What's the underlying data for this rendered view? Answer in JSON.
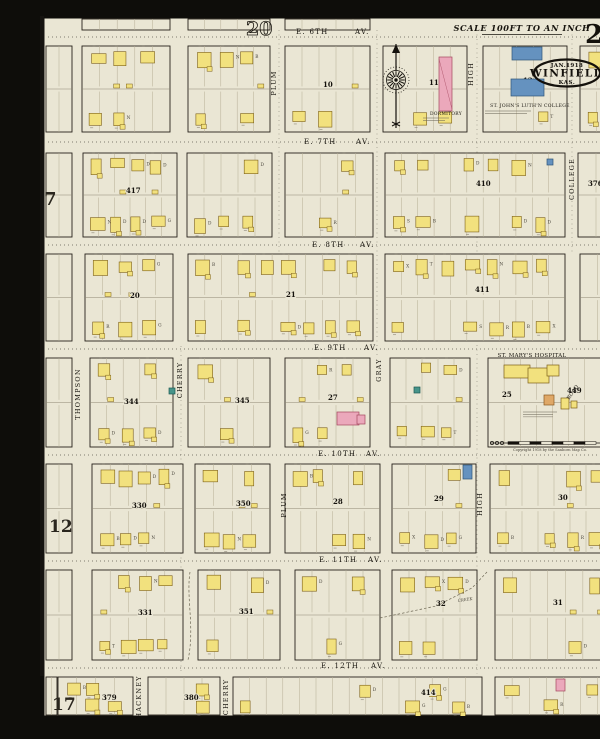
{
  "meta": {
    "sheet_title": "Winfield Kas. Jan. 1918 Sanborn map, sheet 21",
    "scale_text": "SCALE 100FT TO AN INCH",
    "title_oval": {
      "date": "JAN.1918",
      "city": "WINFIELD",
      "state": "KAS."
    },
    "sheet_number": "21",
    "copyright": "Copyright 1918 by the Sanborn Map Co.",
    "colors": {
      "paper": "#eae6d4",
      "ink": "#26211a",
      "lot": "#b5ad94",
      "alley": "#8d8672",
      "frame_fill": "#f2e17e",
      "frame_stroke": "#7c5f17",
      "brick_fill": "#eba8bb",
      "brick_stroke": "#a4485e",
      "special_fill": "#6592bf",
      "special_stroke": "#2e5577",
      "stone_fill": "#47948a",
      "stone_stroke": "#1f5b54",
      "iron_fill": "#dfa867",
      "iron_stroke": "#8a5a20",
      "tiny": "#4a463c"
    }
  },
  "adjacent_sheet_refs": [
    {
      "label": "20",
      "x": 206,
      "y": 19,
      "size": 19,
      "outline": true
    },
    {
      "label": "7",
      "x": 4,
      "y": 189,
      "size": 18,
      "outline": false
    },
    {
      "label": "12",
      "x": 9,
      "y": 516,
      "size": 17,
      "outline": false
    },
    {
      "label": "17",
      "x": 12,
      "y": 694,
      "size": 17,
      "outline": false
    }
  ],
  "sheet_number_pos": {
    "x": 545,
    "y": 27,
    "size": 26
  },
  "corner_numbers": [
    {
      "label": "375",
      "x": 564,
      "y": 73
    }
  ],
  "title_layout": {
    "cx": 527,
    "cy": 57,
    "rx": 33,
    "ry": 13.5,
    "scale_x": 482,
    "scale_y": 15,
    "ul_x1": 442,
    "ul_x2": 522,
    "ul_y": 18.5
  },
  "avenues": [
    {
      "name": "E. 6TH",
      "av": "AV.",
      "xn": 256,
      "xa": 315,
      "y": 18,
      "dash_y": 21
    },
    {
      "name": "E. 7TH",
      "av": "AV.",
      "xn": 264,
      "xa": 316,
      "y": 128,
      "dash_y": 126
    },
    {
      "name": "E. 8TH",
      "av": "AV.",
      "xn": 272,
      "xa": 320,
      "y": 231,
      "dash_y": 229
    },
    {
      "name": "E. 9TH",
      "av": "AV.",
      "xn": 274,
      "xa": 324,
      "y": 334,
      "dash_y": 333
    },
    {
      "name": "E. 10TH",
      "av": "AV.",
      "xn": 278,
      "xa": 326,
      "y": 440,
      "dash_y": 439
    },
    {
      "name": "E. 11TH",
      "av": "AV.",
      "xn": 279,
      "xa": 328,
      "y": 546,
      "dash_y": 545
    },
    {
      "name": "E. 12TH",
      "av": "AV.",
      "xn": 281,
      "xa": 331,
      "y": 652,
      "dash_y": 652
    }
  ],
  "street_labels": [
    {
      "t": "PLUM",
      "x": 236,
      "y": 67
    },
    {
      "t": "PLUM",
      "x": 246,
      "y": 489
    },
    {
      "t": "HIGH",
      "x": 433,
      "y": 58
    },
    {
      "t": "HIGH",
      "x": 442,
      "y": 488
    },
    {
      "t": "GRAY",
      "x": 341,
      "y": 354
    },
    {
      "t": "CHERRY",
      "x": 142,
      "y": 364
    },
    {
      "t": "CHERRY",
      "x": 188,
      "y": 681
    },
    {
      "t": "THOMPSON",
      "x": 40,
      "y": 378
    },
    {
      "t": "COLLEGE",
      "x": 534,
      "y": 163
    },
    {
      "t": "MOUND",
      "x": 584,
      "y": 486
    },
    {
      "t": "HACKNEY",
      "x": 101,
      "y": 681
    }
  ],
  "street_dashes": [
    {
      "x": 239,
      "y1": 14,
      "y2": 236
    },
    {
      "x": 337,
      "y1": 14,
      "y2": 341
    },
    {
      "x": 437,
      "y1": 14,
      "y2": 658
    },
    {
      "x": 532,
      "y1": 14,
      "y2": 238
    },
    {
      "x": 585,
      "y1": 440,
      "y2": 546
    },
    {
      "x": 141,
      "y1": 330,
      "y2": 658
    },
    {
      "x": 580,
      "y1": 344,
      "y2": 430
    }
  ],
  "creek": {
    "path": "M340,602 L396,590 L432,572 L447,556",
    "path2": "M150,556 C146,582 155,612 148,644",
    "label": "CREEK",
    "lx": 418,
    "ly": 586
  },
  "blocks": [
    {
      "r": [
        42,
        3,
        88,
        11
      ],
      "d": 0
    },
    {
      "r": [
        148,
        3,
        82,
        11
      ],
      "d": 0
    },
    {
      "r": [
        245,
        3,
        85,
        11
      ],
      "d": 0
    },
    {
      "r": [
        6,
        30,
        26,
        86
      ],
      "d": 0
    },
    {
      "r": [
        6,
        137,
        26,
        84
      ],
      "d": 0
    },
    {
      "r": [
        6,
        238,
        26,
        87
      ],
      "d": 0
    },
    {
      "r": [
        6,
        342,
        26,
        89
      ],
      "d": 0
    },
    {
      "r": [
        6,
        448,
        26,
        89
      ],
      "d": 0
    },
    {
      "r": [
        6,
        554,
        26,
        90
      ],
      "d": 0
    },
    {
      "r": [
        6,
        661,
        11,
        38
      ],
      "d": 0
    },
    {
      "r": [
        42,
        30,
        88,
        86
      ],
      "d": 0.75
    },
    {
      "r": [
        148,
        30,
        82,
        86
      ],
      "d": 0.7
    },
    {
      "r": [
        245,
        30,
        85,
        86
      ],
      "n": "10",
      "np": [
        283,
        71
      ],
      "d": 0.7
    },
    {
      "r": [
        343,
        30,
        84,
        86
      ],
      "n": "11",
      "np": [
        389,
        69
      ],
      "d": 0.3
    },
    {
      "r": [
        443,
        30,
        84,
        86
      ],
      "n": "12",
      "np": [
        483,
        67
      ],
      "d": 0.12
    },
    {
      "r": [
        540,
        30,
        50,
        86
      ],
      "d": 0.4
    },
    {
      "r": [
        43,
        137,
        94,
        84
      ],
      "n": "417",
      "np": [
        86,
        177
      ],
      "d": 0.8
    },
    {
      "r": [
        147,
        137,
        85,
        84
      ],
      "d": 0.8
    },
    {
      "r": [
        245,
        137,
        88,
        84
      ],
      "d": 0.75
    },
    {
      "r": [
        345,
        137,
        180,
        84
      ],
      "n": "410",
      "np": [
        436,
        170
      ],
      "d": 0.7
    },
    {
      "r": [
        538,
        137,
        54,
        84
      ],
      "n": "376",
      "np": [
        548,
        170
      ],
      "d": 0.45
    },
    {
      "r": [
        45,
        238,
        88,
        87
      ],
      "n": "20",
      "np": [
        90,
        282
      ],
      "d": 0.8
    },
    {
      "r": [
        148,
        238,
        185,
        87
      ],
      "n": "21",
      "np": [
        246,
        281
      ],
      "d": 0.75
    },
    {
      "r": [
        345,
        238,
        180,
        87
      ],
      "n": "411",
      "np": [
        435,
        276
      ],
      "d": 0.7
    },
    {
      "r": [
        540,
        238,
        52,
        87
      ],
      "d": 0.4
    },
    {
      "r": [
        50,
        342,
        83,
        89
      ],
      "n": "344",
      "np": [
        84,
        388
      ],
      "d": 0.8
    },
    {
      "r": [
        148,
        342,
        82,
        89
      ],
      "n": "345",
      "np": [
        195,
        387
      ],
      "d": 0.7
    },
    {
      "r": [
        245,
        342,
        85,
        89
      ],
      "n": "27",
      "np": [
        288,
        384
      ],
      "d": 0.7
    },
    {
      "r": [
        350,
        342,
        80,
        89
      ],
      "d": 0.75
    },
    {
      "r": [
        448,
        342,
        129,
        89
      ],
      "n": "25",
      "np": [
        462,
        381
      ],
      "d": 0
    },
    {
      "r": [
        52,
        448,
        91,
        89
      ],
      "n": "330",
      "np": [
        92,
        492
      ],
      "d": 0.8
    },
    {
      "r": [
        155,
        448,
        75,
        89
      ],
      "n": "350",
      "np": [
        196,
        490
      ],
      "d": 0.75
    },
    {
      "r": [
        245,
        448,
        95,
        89
      ],
      "n": "28",
      "np": [
        293,
        488
      ],
      "d": 0.7
    },
    {
      "r": [
        352,
        448,
        84,
        89
      ],
      "n": "29",
      "np": [
        394,
        485
      ],
      "d": 0.75
    },
    {
      "r": [
        450,
        448,
        128,
        89
      ],
      "n": "30",
      "np": [
        518,
        484
      ],
      "d": 0.65
    },
    {
      "r": [
        52,
        554,
        91,
        90
      ],
      "n": "331",
      "np": [
        98,
        599
      ],
      "d": 0.8
    },
    {
      "r": [
        158,
        554,
        82,
        90
      ],
      "n": "351",
      "np": [
        199,
        598
      ],
      "d": 0.6
    },
    {
      "r": [
        255,
        554,
        85,
        90
      ],
      "d": 0.6
    },
    {
      "r": [
        352,
        554,
        85,
        90
      ],
      "n": "32",
      "np": [
        396,
        590
      ],
      "d": 0.65
    },
    {
      "r": [
        455,
        554,
        123,
        90
      ],
      "n": "31",
      "np": [
        513,
        589
      ],
      "d": 0.5
    },
    {
      "r": [
        18,
        661,
        75,
        38
      ],
      "n": "379",
      "np": [
        62,
        684
      ],
      "d": 0.7
    },
    {
      "r": [
        108,
        661,
        72,
        38
      ],
      "n": "380",
      "np": [
        144,
        684
      ],
      "d": 0.4
    },
    {
      "r": [
        193,
        661,
        249,
        38
      ],
      "n": "414",
      "np": [
        381,
        679
      ],
      "d": 0.35
    },
    {
      "r": [
        455,
        661,
        137,
        38
      ],
      "d": 0.5
    }
  ],
  "special_buildings": [
    {
      "name": "dormitory-building",
      "r": [
        399,
        41,
        13,
        54
      ],
      "c": "brick"
    },
    {
      "name": "college-building-north",
      "r": [
        472,
        31,
        30,
        13
      ],
      "c": "special"
    },
    {
      "name": "college-building-south",
      "r": [
        471,
        63,
        33,
        17
      ],
      "c": "special"
    },
    {
      "name": "special-building",
      "r": [
        507,
        143,
        6,
        6
      ],
      "c": "special"
    },
    {
      "name": "stone-building",
      "r": [
        374,
        371,
        6,
        6
      ],
      "c": "stone"
    },
    {
      "name": "stone-building",
      "r": [
        129,
        372,
        6,
        6
      ],
      "c": "stone"
    },
    {
      "name": "special-building",
      "r": [
        423,
        449,
        9,
        14
      ],
      "c": "special"
    },
    {
      "name": "brick-building",
      "r": [
        297,
        396,
        22,
        13
      ],
      "c": "brick"
    },
    {
      "name": "brick-building",
      "r": [
        317,
        399,
        8,
        9
      ],
      "c": "brick"
    },
    {
      "name": "brick-building",
      "r": [
        516,
        663,
        9,
        12
      ],
      "c": "brick"
    },
    {
      "name": "hospital-building",
      "r": [
        464,
        349,
        26,
        13
      ],
      "c": "frame"
    },
    {
      "name": "hospital-building",
      "r": [
        488,
        352,
        21,
        15
      ],
      "c": "frame"
    },
    {
      "name": "hospital-building",
      "r": [
        507,
        349,
        12,
        11
      ],
      "c": "frame"
    },
    {
      "name": "hospital-outbuilding",
      "r": [
        504,
        379,
        10,
        10
      ],
      "c": "iron"
    },
    {
      "name": "hospital-outbuilding",
      "r": [
        521,
        382,
        8,
        11
      ],
      "c": "frame"
    },
    {
      "name": "hospital-outbuilding",
      "r": [
        531,
        385,
        6,
        7
      ],
      "c": "frame"
    }
  ],
  "hospital_block_number": {
    "label": "449",
    "x": 527,
    "y": 377
  },
  "landmark_labels": [
    {
      "t": "ST. JOHN'S LUTH'N COLLEGE",
      "x": 490,
      "y": 91,
      "s": 4.6,
      "rot": 0
    },
    {
      "t": "DORMITORY",
      "x": 406,
      "y": 99,
      "s": 4.4,
      "rot": 0
    },
    {
      "t": "ST. MARY'S HOSPITAL",
      "x": 492,
      "y": 341,
      "s": 5.4,
      "rot": 0
    },
    {
      "t": "ROAD",
      "x": 534,
      "y": 377,
      "s": 5,
      "rot": -55
    }
  ],
  "fine_print_notes": [
    {
      "x": 468,
      "y": 95,
      "w": 46,
      "lines": 2
    },
    {
      "x": 396,
      "y": 102,
      "w": 26,
      "lines": 2
    },
    {
      "x": 500,
      "y": 396,
      "w": 34,
      "lines": 3
    }
  ],
  "compass": {
    "cx": 356,
    "cy": 64,
    "needle_top": 28,
    "needle_bot": 112
  },
  "scale_bar": {
    "x1": 450,
    "x2": 562,
    "y": 427
  },
  "house_codes": [
    "D",
    "D",
    "D",
    "B",
    "X",
    "S",
    "R",
    "G",
    "N",
    "T"
  ]
}
